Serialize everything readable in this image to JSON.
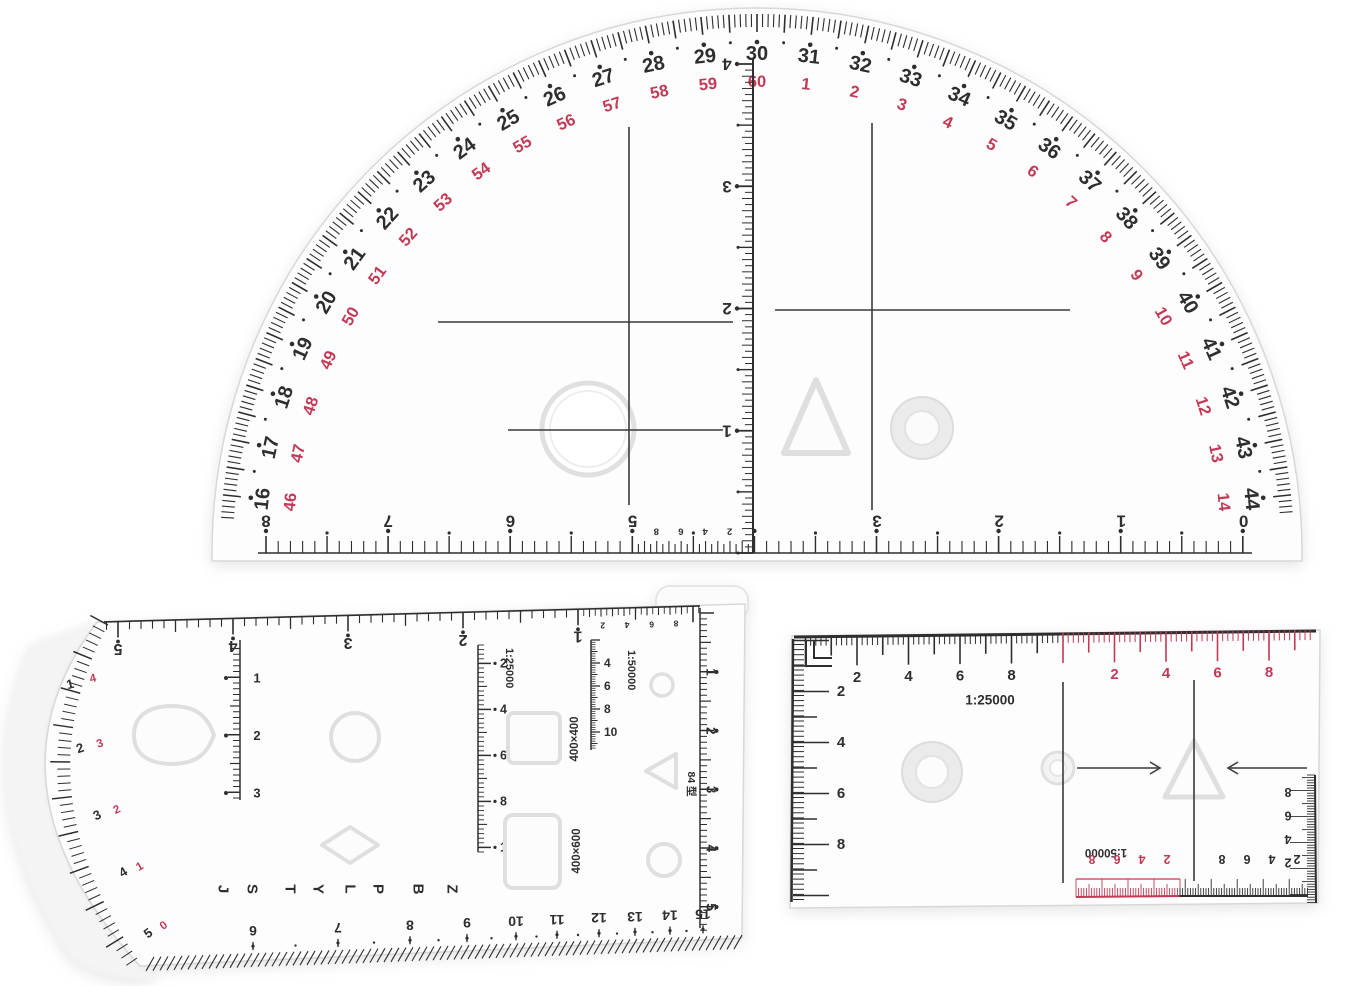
{
  "photo": {
    "items": [
      "semicircular-protractor",
      "coordinate-template-ruler",
      "dual-scale-ruler"
    ]
  },
  "colors": {
    "ink": "#2e2e2e",
    "red_ink": "#c23a55",
    "plastic_fill": "#fdfdfd",
    "plastic_edge": "#d8d8d8",
    "emboss_stroke": "#dfdfdf",
    "background": "#ffffff"
  },
  "protractor": {
    "arc_black_numbers": [
      "16",
      "17",
      "18",
      "19",
      "20",
      "21",
      "22",
      "23",
      "24",
      "25",
      "26",
      "27",
      "28",
      "29",
      "30",
      "31",
      "32",
      "33",
      "34",
      "35",
      "36",
      "37",
      "38",
      "39",
      "40",
      "41",
      "42",
      "43",
      "44"
    ],
    "arc_red_numbers": [
      "46",
      "47",
      "48",
      "49",
      "50",
      "51",
      "52",
      "53",
      "54",
      "55",
      "56",
      "57",
      "58",
      "59",
      "60",
      "1",
      "2",
      "3",
      "4",
      "5",
      "6",
      "7",
      "8",
      "9",
      "10",
      "11",
      "12",
      "13",
      "14"
    ],
    "bottom_scale_numbers": [
      "8",
      "7",
      "6",
      "5",
      "3",
      "2",
      "1",
      "0"
    ],
    "bottom_tenth_numbers": [
      "8",
      "6",
      "4",
      "2"
    ],
    "center_ruler_numbers": [
      "4",
      "3",
      "2",
      "1"
    ]
  },
  "template_ruler": {
    "top_numbers": [
      "5",
      "4",
      "3",
      "2",
      "1"
    ],
    "top_tenth_numbers": [
      "2",
      "4",
      "6",
      "8"
    ],
    "arc_black_numbers": [
      "1",
      "2",
      "3",
      "4",
      "5"
    ],
    "arc_red_numbers": [
      "4",
      "3",
      "2",
      "1",
      "0"
    ],
    "inner_ruler_numbers": [
      "1",
      "2",
      "3"
    ],
    "scale_25000": {
      "label": "1:25000",
      "numbers": [
        "2",
        "4",
        "6",
        "8",
        "10"
      ]
    },
    "scale_50000": {
      "label": "1:50000",
      "numbers": [
        "4",
        "6",
        "8",
        "10"
      ]
    },
    "square_label": "400×400",
    "rectangle_label": "400×600",
    "letters": [
      "J",
      "S",
      "T",
      "Y",
      "L",
      "P",
      "B",
      "Z"
    ],
    "model_label": "84 型",
    "right_numbers": [
      "1",
      "2",
      "3",
      "4",
      "5"
    ],
    "slope_numbers": [
      "6",
      "7",
      "8",
      "9",
      "10",
      "11",
      "12",
      "13",
      "14",
      "15"
    ]
  },
  "scale_ruler": {
    "top_black_numbers": [
      "2",
      "4",
      "6",
      "8"
    ],
    "top_red_numbers": [
      "2",
      "4",
      "6",
      "8"
    ],
    "left_numbers": [
      "2",
      "4",
      "6",
      "8"
    ],
    "label_25000": "1:25000",
    "label_50000": "1:50000",
    "bottom_red_numbers": [
      "8",
      "6",
      "4",
      "2"
    ],
    "bottom_black_numbers": [
      "8",
      "6",
      "4",
      "2"
    ],
    "right_numbers": [
      "8",
      "6",
      "4",
      "2"
    ]
  }
}
